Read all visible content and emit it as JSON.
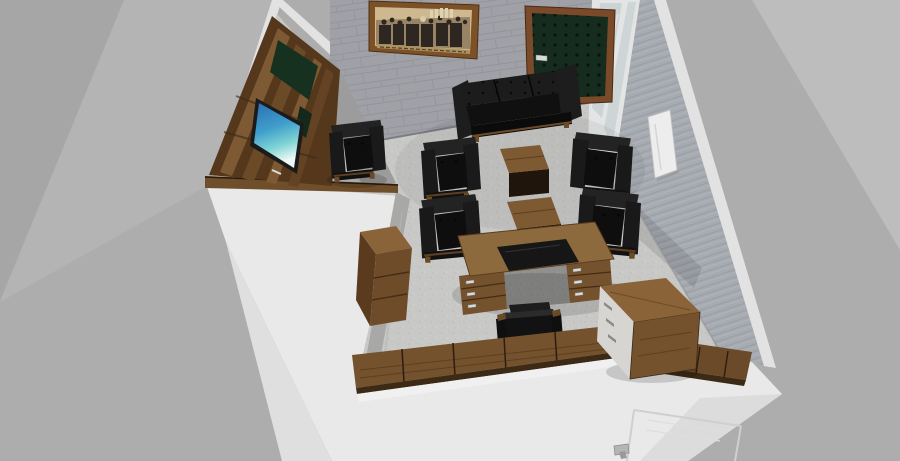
{
  "meta": {
    "description": "3D top-down perspective render of an L-shaped executive office suite on a plain gray backdrop",
    "view": "isometric-top-down-render",
    "canvas": {
      "width": 900,
      "height": 461
    }
  },
  "colors": {
    "bg": "#adadad",
    "bgLight": "#bdbdbd",
    "bgDark": "#a6a6a6",
    "wallPlane": "#b4b4b4",
    "wallWhite": "#e9e9e9",
    "wallEdge": "#e2e2e2",
    "brickWall": "#9c9da3",
    "stripeWall": "#a6abb1",
    "grayWall": "#9c9c9c",
    "floor": "#c8c8c6",
    "woodLight": "#8d6a3e",
    "woodMid": "#74522e",
    "woodDark": "#55371c",
    "woodCap": "#6f4e2b",
    "leather": "#161616",
    "doorGreen": "#152c1e",
    "doorFrame": "#7b4a2a",
    "pictureFrame": "#7d5128",
    "photoSepia": "#cdb88f",
    "tvBlue": "#2a6fb4",
    "glass": "#ccd3d5",
    "radiator": "#ededed"
  },
  "rooms": [
    {
      "id": "lounge",
      "label": "tv-lounge-room-upper-left",
      "items": [
        "media-wall-unit",
        "flat-screen-tv",
        "leather-armchair"
      ]
    },
    {
      "id": "office",
      "label": "executive-office-main-room",
      "items": [
        "framed-sepia-photograph",
        "green-tufted-door",
        "glass-partition",
        "wall-radiator",
        "black-leather-sofa",
        "four-armchairs",
        "two-coffee-tables",
        "executive-desk",
        "desk-chair",
        "side-cabinet",
        "bookcase",
        "sideboard-row",
        "exterior-door-panel"
      ]
    }
  ],
  "objects": [
    {
      "id": "sepia-photo",
      "label": "framed historical sepia photograph",
      "color": "#cdb88f"
    },
    {
      "id": "entry-door",
      "label": "dark green tufted entry door",
      "color": "#152c1e"
    },
    {
      "id": "partition",
      "label": "glazed partition wall",
      "color": "#ccd3d5"
    },
    {
      "id": "radiator",
      "label": "wall radiator panel",
      "color": "#ededed"
    },
    {
      "id": "sofa",
      "label": "black leather three-seat sofa",
      "color": "#161616"
    },
    {
      "id": "armchairs",
      "label": "black leather armchairs (5)",
      "color": "#161616"
    },
    {
      "id": "coffee-tables",
      "label": "walnut coffee tables (2)",
      "color": "#7e5a33"
    },
    {
      "id": "desk",
      "label": "executive desk with leather inlay",
      "color": "#8d6a3e"
    },
    {
      "id": "desk-chair",
      "label": "black desk chair",
      "color": "#121212"
    },
    {
      "id": "tv",
      "label": "flat screen tv with ocean wallpaper",
      "color": "#2a6fb4"
    },
    {
      "id": "tv-unit",
      "label": "walnut media wall unit",
      "color": "#55371c"
    },
    {
      "id": "cabinets",
      "label": "walnut cabinets and sideboards",
      "color": "#74522e"
    }
  ]
}
